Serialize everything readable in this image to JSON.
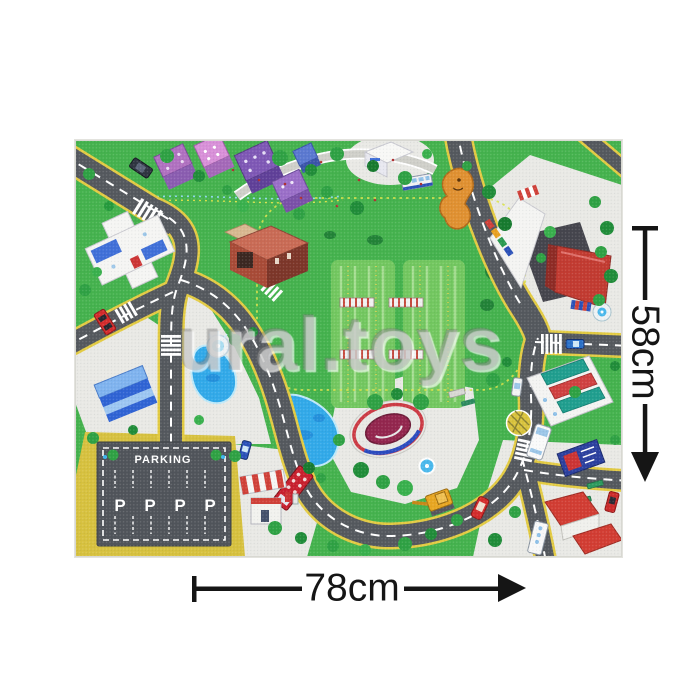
{
  "photo": {
    "watermark_text": "ural.toys",
    "mat": {
      "parking_sign": "PARKING",
      "parking_letters": [
        "P",
        "P",
        "P",
        "P"
      ]
    },
    "dimensions": {
      "height_label": "58cm",
      "width_label": "78cm"
    }
  },
  "colors": {
    "page_background": "#ffffff",
    "grass": "#44b24d",
    "road_asphalt": "#54585d",
    "road_edge_yellow": "#e3cb42",
    "road_marking_white": "#ffffff",
    "sidewalk": "#e9e9e5",
    "sand_lot": "#d7c13e",
    "parking_asphalt": "#50545a",
    "pond_blue": "#31a9e9",
    "stadium_infield": "#93254d",
    "dimension_ink": "#151515",
    "watermark_gray": "#a5a5a5"
  }
}
